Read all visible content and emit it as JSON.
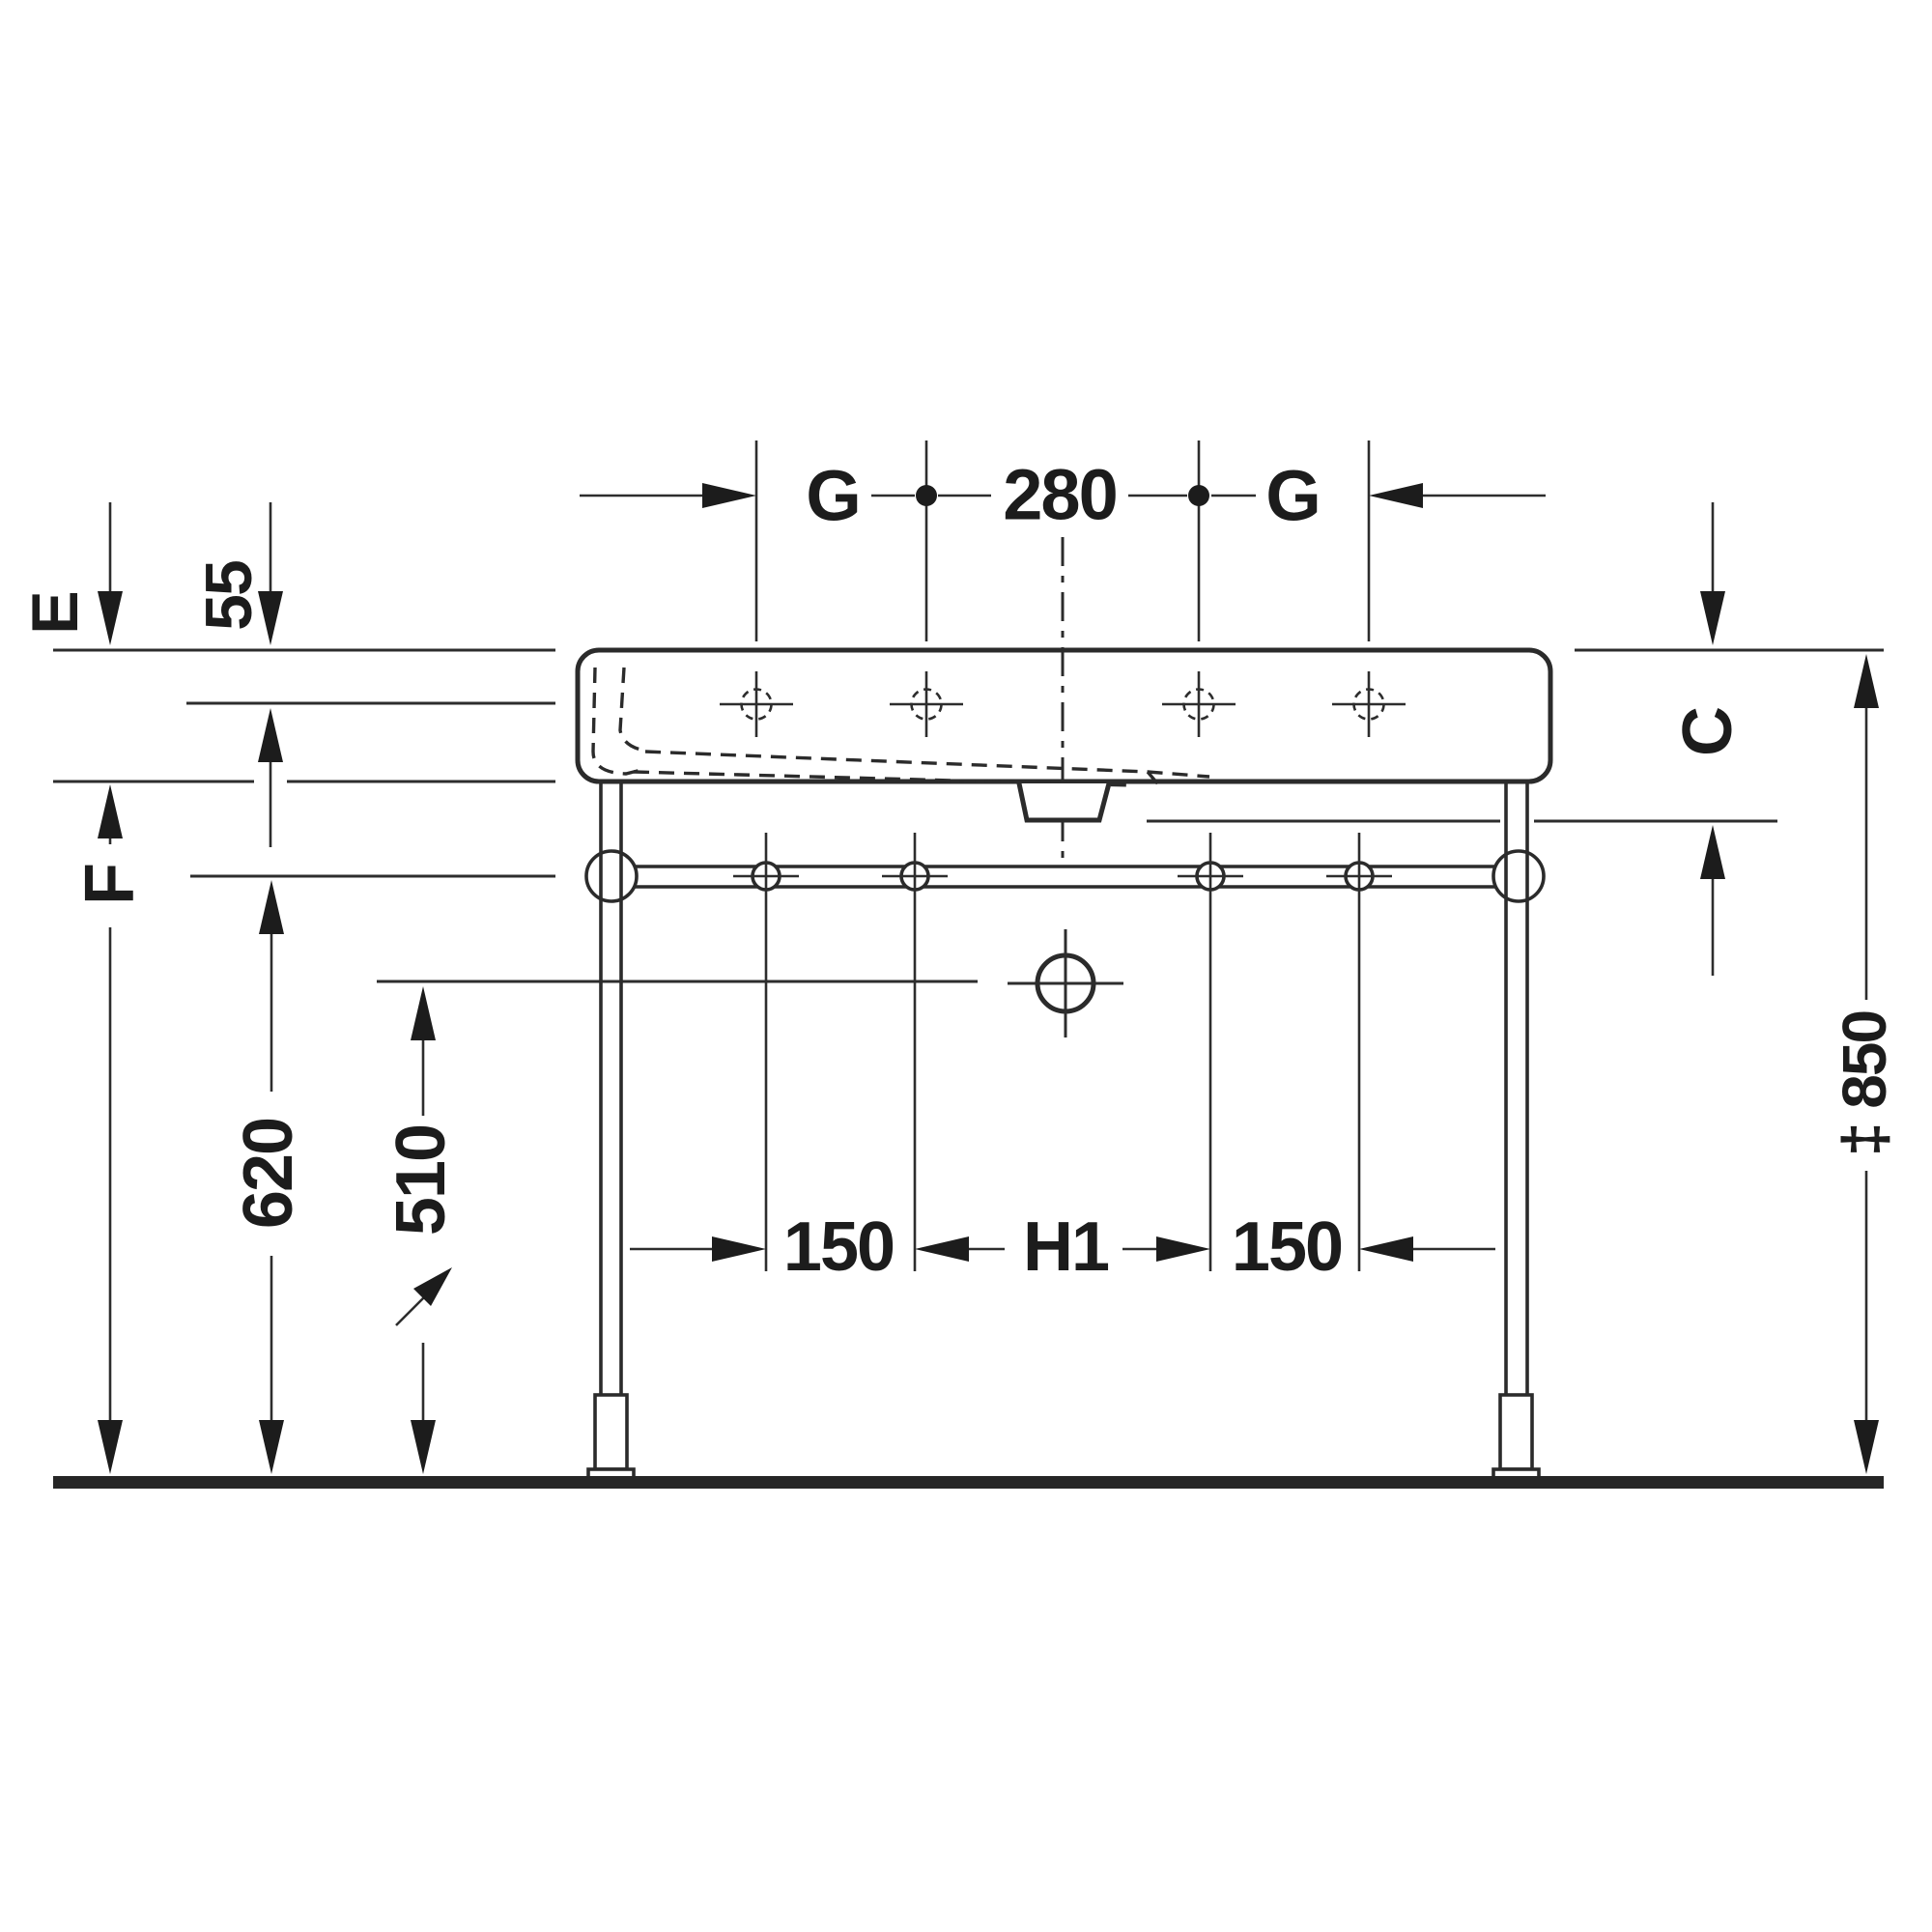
{
  "drawing": {
    "type": "technical dimension drawing",
    "subject": "washbasin with metal console stand, front elevation",
    "colors": {
      "line": "#2d2d2d",
      "text": "#1c1c1c",
      "background": "#ffffff",
      "floor": "#262626"
    },
    "dimensions": {
      "top": {
        "g_left": "G",
        "center": "280",
        "g_right": "G"
      },
      "left": {
        "e": "E",
        "rim_thickness": "55",
        "f": "F",
        "rail_height": "620",
        "outlet_height": "510"
      },
      "right": {
        "c": "C",
        "total_height": "‡ 850"
      },
      "bottom": {
        "left_150": "150",
        "center_h1": "H1",
        "right_150": "150"
      }
    }
  }
}
